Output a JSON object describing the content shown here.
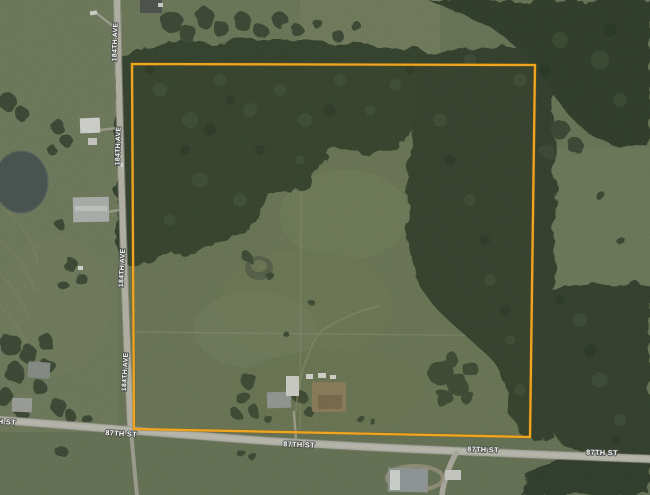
{
  "map": {
    "view_type": "satellite-imagery",
    "road_labels": {
      "horizontal_street": "87TH ST",
      "vertical_avenue": "184TH AVE",
      "horizontal_instances": 5,
      "vertical_instances": 4
    },
    "parcel_overlay": {
      "shape": "quadrilateral",
      "stroke_color": "#F0A41F"
    },
    "terrain_colors": {
      "field_green": "#6D7B58",
      "forest_green": "#31402B",
      "road_gray": "#BDBDB2",
      "pond_gray_green": "#495651",
      "dirt_tan": "#96835F"
    }
  }
}
